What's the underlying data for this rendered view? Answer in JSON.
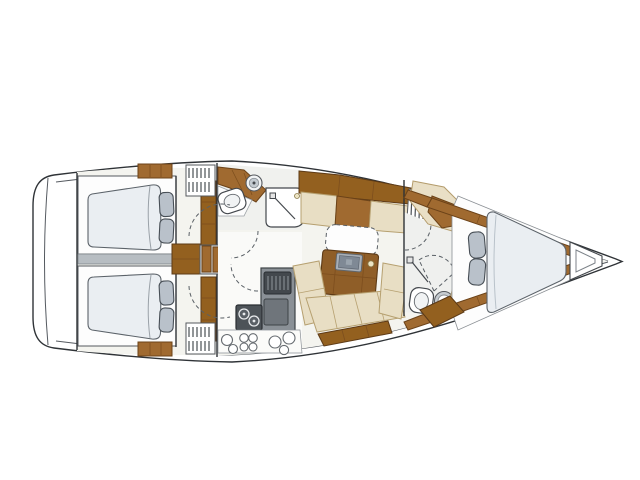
{
  "page": {
    "background": "#ffffff"
  },
  "diagram": {
    "title": "Sailing yacht interior layout floor plan (top view, bow to the right)",
    "type": "yacht-floorplan",
    "orientation": {
      "bow": "right",
      "stern": "left"
    },
    "palette": {
      "outline": "#2f3337",
      "wood": "#a06a30",
      "wood_dark": "#6b4218",
      "upholstery_beige": "#e8dec4",
      "mattress_gray_blue": "#eaeef2",
      "pillow_gray": "#b9c1ca",
      "appliance_gray": "#8a9096",
      "appliance_dark": "#43484d",
      "floor_light": "#f4f4ef",
      "divider_gray": "#b7bdc2"
    },
    "rooms": [
      {
        "name": "Aft cabin port",
        "fixtures": [
          "double berth",
          "mattress",
          "2 pillows",
          "wardrobe trim"
        ]
      },
      {
        "name": "Aft cabin starboard",
        "fixtures": [
          "double berth",
          "mattress",
          "2 pillows",
          "wardrobe trim"
        ]
      },
      {
        "name": "Aft head",
        "fixtures": [
          "toilet",
          "round washbasin on wood counter",
          "shower stall",
          "louvered locker"
        ]
      },
      {
        "name": "Galley",
        "fixtures": [
          "oven-fridge unit",
          "two-burner stove",
          "round twin sinks",
          "counter",
          "louvered locker"
        ]
      },
      {
        "name": "Saloon",
        "fixtures": [
          "folding table with dashed leaf",
          "table inset tray",
          "side settee",
          "U-shaped settee",
          "under-seat wood stowage"
        ]
      },
      {
        "name": "Companionway",
        "fixtures": [
          "wood steps"
        ]
      },
      {
        "name": "Forward head",
        "fixtures": [
          "toilet",
          "round washbasin",
          "shower mixer",
          "corner seat",
          "louvered locker"
        ]
      },
      {
        "name": "Forward cabin",
        "fixtures": [
          "V-berth mattress",
          "2 pillows",
          "anchor locker",
          "side shelves"
        ]
      }
    ]
  }
}
